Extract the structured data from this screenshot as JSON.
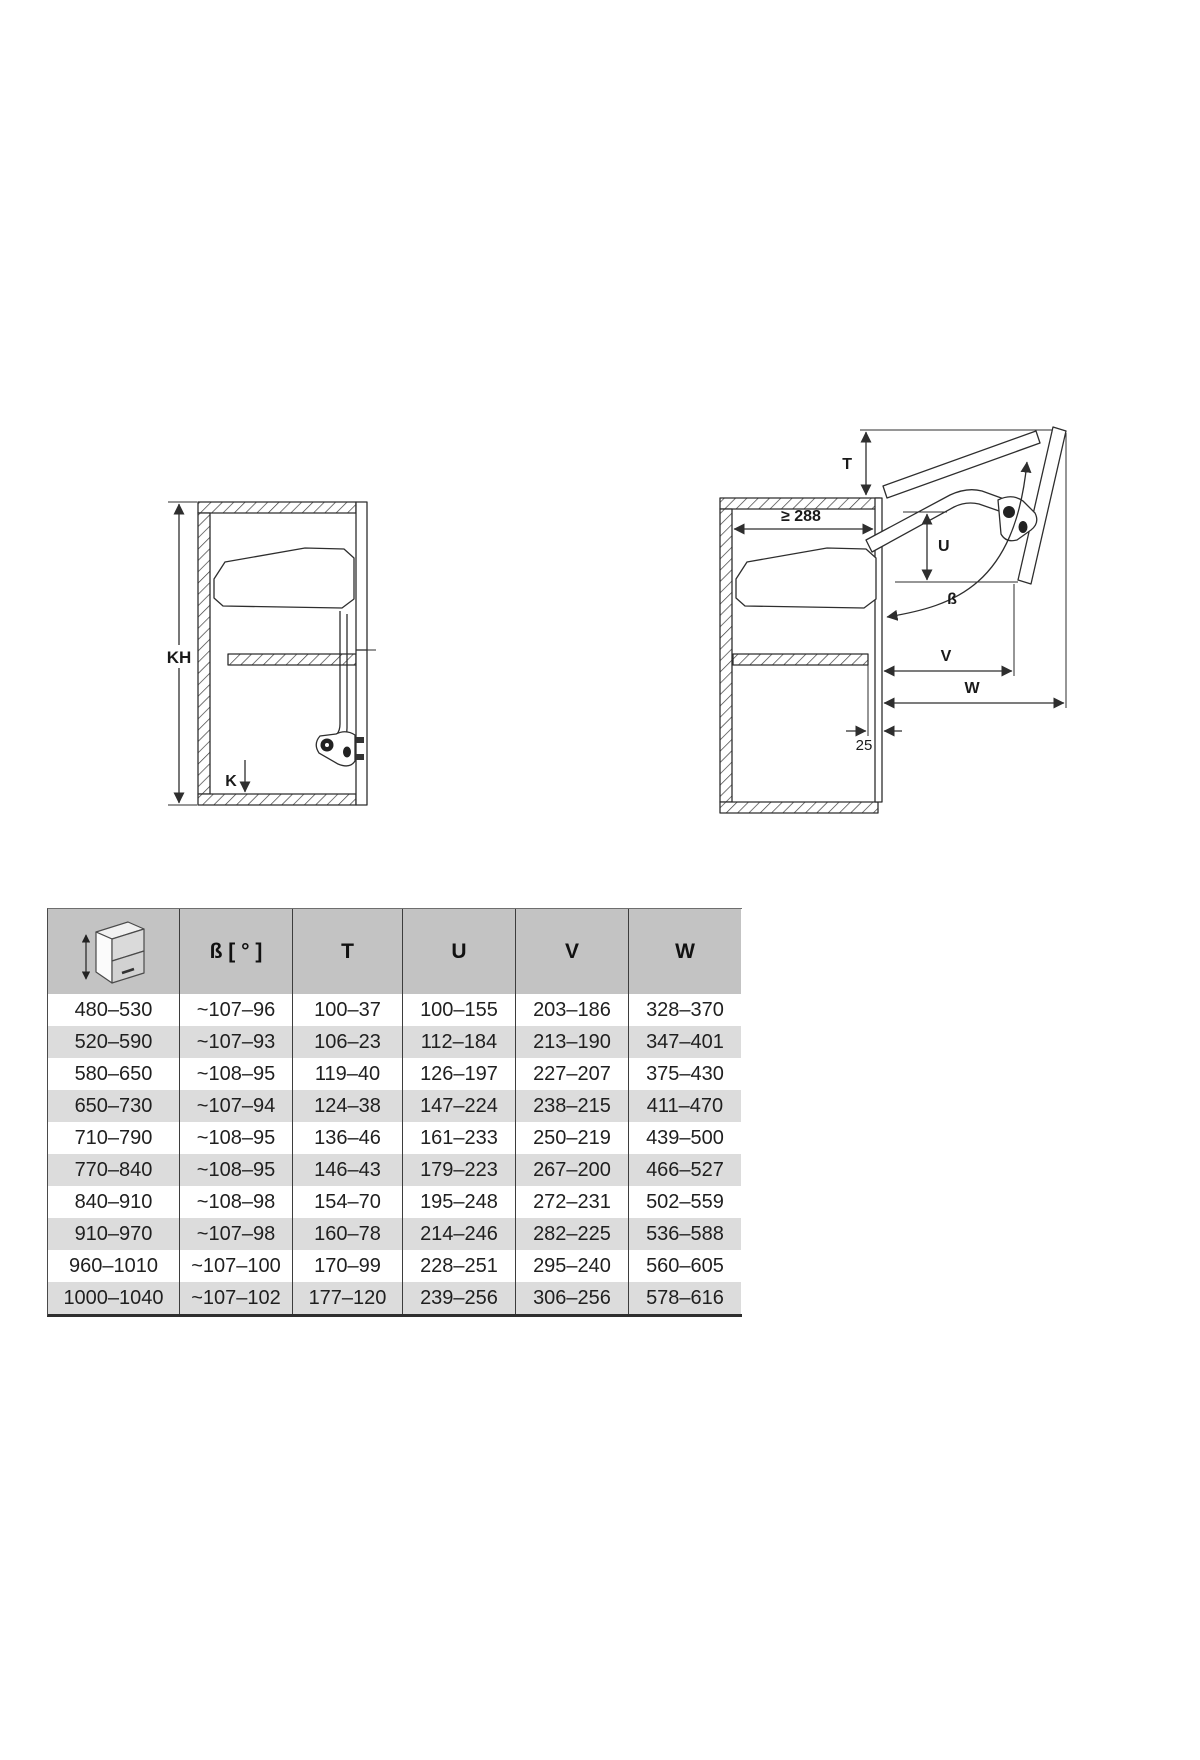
{
  "diagram_closed": {
    "kh_label": "KH",
    "k_label": "K"
  },
  "diagram_open": {
    "t_label": "T",
    "u_label": "U",
    "v_label": "V",
    "w_label": "W",
    "beta_label": "ß",
    "min_inner_depth": "≥ 288",
    "front_offset": "25"
  },
  "table": {
    "headers": {
      "kh_icon": "cabinet-height-icon",
      "beta": "ß [ ° ]",
      "t": "T",
      "u": "U",
      "v": "V",
      "w": "W"
    },
    "rows": [
      {
        "kh": "480–530",
        "beta": "~107–96",
        "t": "100–37",
        "u": "100–155",
        "v": "203–186",
        "w": "328–370"
      },
      {
        "kh": "520–590",
        "beta": "~107–93",
        "t": "106–23",
        "u": "112–184",
        "v": "213–190",
        "w": "347–401"
      },
      {
        "kh": "580–650",
        "beta": "~108–95",
        "t": "119–40",
        "u": "126–197",
        "v": "227–207",
        "w": "375–430"
      },
      {
        "kh": "650–730",
        "beta": "~107–94",
        "t": "124–38",
        "u": "147–224",
        "v": "238–215",
        "w": "411–470"
      },
      {
        "kh": "710–790",
        "beta": "~108–95",
        "t": "136–46",
        "u": "161–233",
        "v": "250–219",
        "w": "439–500"
      },
      {
        "kh": "770–840",
        "beta": "~108–95",
        "t": "146–43",
        "u": "179–223",
        "v": "267–200",
        "w": "466–527"
      },
      {
        "kh": "840–910",
        "beta": "~108–98",
        "t": "154–70",
        "u": "195–248",
        "v": "272–231",
        "w": "502–559"
      },
      {
        "kh": "910–970",
        "beta": "~107–98",
        "t": "160–78",
        "u": "214–246",
        "v": "282–225",
        "w": "536–588"
      },
      {
        "kh": "960–1010",
        "beta": "~107–100",
        "t": "170–99",
        "u": "228–251",
        "v": "295–240",
        "w": "560–605"
      },
      {
        "kh": "1000–1040",
        "beta": "~107–102",
        "t": "177–120",
        "u": "239–256",
        "v": "306–256",
        "w": "578–616"
      }
    ]
  },
  "colors": {
    "header_bg": "#c3c3c3",
    "row_bg": "#ffffff",
    "row_alt_bg": "#dcdcdc",
    "line": "#2e2e2e",
    "text": "#1a1a1a"
  }
}
